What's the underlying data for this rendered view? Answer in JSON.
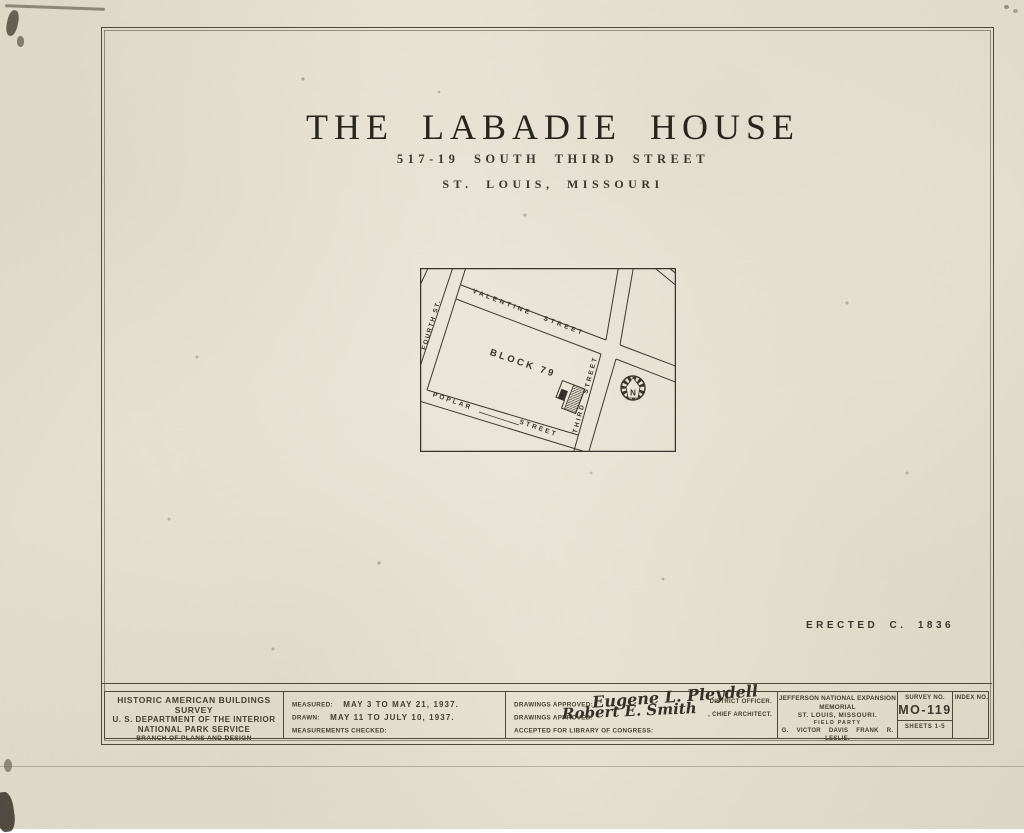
{
  "page": {
    "title": "THE LABADIE HOUSE",
    "subtitle": "517-19 SOUTH THIRD STREET",
    "location": "ST. LOUIS, MISSOURI",
    "erected": "ERECTED C. 1836"
  },
  "map": {
    "block": "BLOCK 79",
    "north": "N",
    "streets": {
      "valentine": "VALENTINE STREET",
      "fourth": "FOURTH ST.",
      "third": "THIRD STREET",
      "poplar1": "POPLAR",
      "poplar2": "STREET"
    }
  },
  "tb": {
    "agency": {
      "l1": "HISTORIC AMERICAN BUILDINGS SURVEY",
      "l2": "U. S. DEPARTMENT OF THE INTERIOR",
      "l3": "NATIONAL PARK SERVICE",
      "l4": "BRANCH OF PLANS AND DESIGN"
    },
    "dates": {
      "measured_label": "MEASURED:",
      "measured_value": "MAY 3  TO  MAY 21, 1937.",
      "drawn_label": "DRAWN:",
      "drawn_value": "MAY 11  TO  JULY 10, 1937.",
      "checked_label": "MEASUREMENTS CHECKED:"
    },
    "approvals": {
      "approved_label": "DRAWINGS APPROVED:",
      "sig1": "Eugene L. Pleydell",
      "sig1_title": "DISTRICT OFFICER.",
      "sig2": "Robert E. Smith",
      "sig2_title": ", CHIEF ARCHITECT.",
      "accepted_label": "ACCEPTED FOR LIBRARY OF CONGRESS:"
    },
    "project": {
      "l1": "JEFFERSON NATIONAL EXPANSION MEMORIAL",
      "l2": "ST. LOUIS, MISSOURI.",
      "l3": "FIELD PARTY",
      "l4": "G. VICTOR DAVIS   FRANK R. LESLIE."
    },
    "survey": {
      "label": "SURVEY NO.",
      "number": "MO-119",
      "sheets": "SHEETS 1-5"
    },
    "index": {
      "label": "INDEX NO."
    }
  },
  "colors": {
    "paper": "#e7e2d2",
    "ink": "#37332a",
    "border": "#4f4937"
  }
}
